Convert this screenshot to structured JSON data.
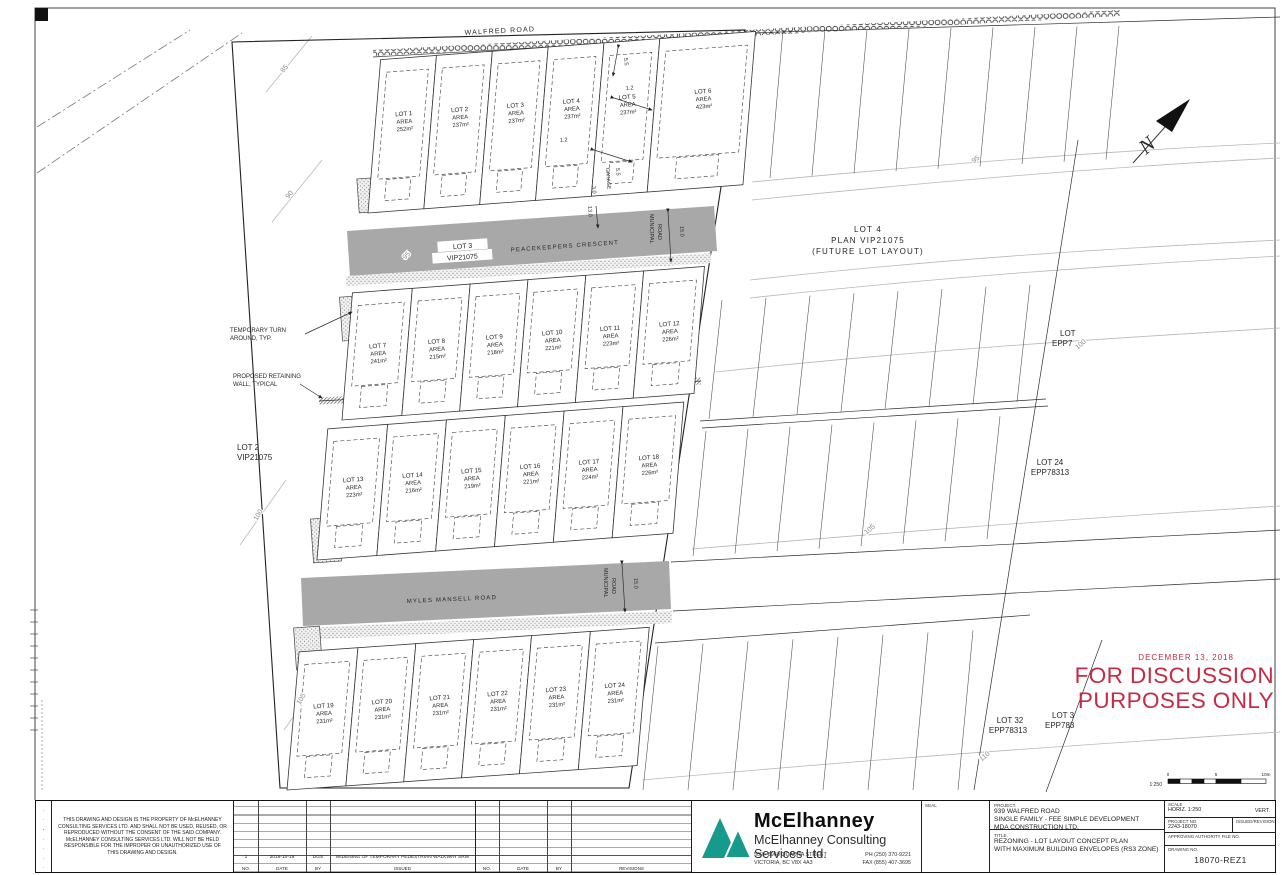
{
  "colors": {
    "stamp_red": "#c62a45",
    "logo_teal": "#159a8b",
    "road_gray": "#a8a8a8"
  },
  "plan": {
    "roads": {
      "walfred": "WALFRED ROAD",
      "peacekeepers": "PEACEKEEPERS CRESCENT",
      "myles": "MYLES MANSELL ROAD",
      "municipal1": "MUNICIPAL",
      "municipal2": "ROAD"
    },
    "area_label": "AREA",
    "lots": [
      {
        "name": "LOT 1",
        "area": "252m²"
      },
      {
        "name": "LOT 2",
        "area": "237m²"
      },
      {
        "name": "LOT 3",
        "area": "237m²"
      },
      {
        "name": "LOT 4",
        "area": "237m²"
      },
      {
        "name": "LOT 5",
        "area": "237m²"
      },
      {
        "name": "LOT 6",
        "area": "423m²"
      },
      {
        "name": "LOT 7",
        "area": "241m²"
      },
      {
        "name": "LOT 8",
        "area": "215m²"
      },
      {
        "name": "LOT 9",
        "area": "218m²"
      },
      {
        "name": "LOT 10",
        "area": "221m²"
      },
      {
        "name": "LOT 11",
        "area": "223m²"
      },
      {
        "name": "LOT 12",
        "area": "226m²"
      },
      {
        "name": "LOT 13",
        "area": "223m²"
      },
      {
        "name": "LOT 14",
        "area": "216m²"
      },
      {
        "name": "LOT 15",
        "area": "219m²"
      },
      {
        "name": "LOT 16",
        "area": "221m²"
      },
      {
        "name": "LOT 17",
        "area": "224m²"
      },
      {
        "name": "LOT 18",
        "area": "226m²"
      },
      {
        "name": "LOT 19",
        "area": "231m²"
      },
      {
        "name": "LOT 20",
        "area": "231m²"
      },
      {
        "name": "LOT 21",
        "area": "231m²"
      },
      {
        "name": "LOT 22",
        "area": "231m²"
      },
      {
        "name": "LOT 23",
        "area": "231m²"
      },
      {
        "name": "LOT 24",
        "area": "231m²"
      }
    ],
    "adjacent": {
      "lot3road": {
        "l1": "LOT 3",
        "l2": "VIP21075"
      },
      "lot2": {
        "l1": "LOT 2",
        "l2": "VIP21075"
      },
      "lot4": {
        "l1": "LOT 4",
        "l2": "PLAN VIP21075",
        "l3": "(FUTURE LOT LAYOUT)"
      },
      "eppA": {
        "l1": "LOT",
        "l2": "EPP7"
      },
      "lot24": {
        "l1": "LOT 24",
        "l2": "EPP78313"
      },
      "lot32": {
        "l1": "LOT 32",
        "l2": "EPP78313"
      },
      "eppB": {
        "l1": "LOT 3",
        "l2": "EPP783"
      }
    },
    "annotations": {
      "turn1": "TEMPORARY TURN",
      "turn2": "AROUND, TYP.",
      "ret1": "PROPOSED RETAINING",
      "ret2": "WALL, TYPICAL",
      "garage": "GARAGE"
    },
    "contours": {
      "c85": "85",
      "c90": "90",
      "c95l": "95",
      "c95r": "95",
      "c100l": "100",
      "c100r": "100",
      "c105l": "105",
      "c105r": "105",
      "c110": "110"
    },
    "dims": {
      "v55a": "5.5",
      "v12a": "1.2",
      "v12b": "1.2",
      "v55b": "5.5",
      "v30": "3.0",
      "v130": "13.0",
      "v150a": "15.0",
      "v150b": "15.0"
    },
    "north": "N",
    "scalebar": {
      "ratio": "1:250",
      "t0": "0",
      "t5": "5",
      "t10": "10m"
    }
  },
  "stamp": {
    "date": "DECEMBER 13, 2018",
    "line1": "FOR DISCUSSION",
    "line2": "PURPOSES ONLY"
  },
  "titleblock": {
    "copyright": "THIS DRAWING AND DESIGN IS THE PROPERTY OF McELHANNEY CONSULTING SERVICES LTD. AND SHALL NOT BE USED, REUSED, OR REPRODUCED WITHOUT THE CONSENT OF THE SAID COMPANY. McELHANNEY CONSULTING SERVICES LTD. WILL NOT BE HELD RESPONSIBLE FOR THE IMPROPER OR UNAUTHORIZED USE OF THIS DRAWING AND DESIGN.",
    "rev": {
      "h_no": "NO.",
      "h_date": "DATE",
      "h_by": "BY",
      "h_issued": "ISSUED",
      "h_revisions": "REVISIONS",
      "entry_no": "1",
      "entry_date": "2018-10-19",
      "entry_by": "DGS",
      "entry_desc": "WIDENING OF TEMPORARY PEDESTRIAN WALKWAY SRW"
    },
    "company": {
      "logo_name": "McElhanney",
      "name": "McElhanney Consulting Services Ltd.",
      "addr1": "500 - 3960 QUADRA STREET",
      "addr2": "VICTORIA, BC V8X 4A3",
      "ph": "PH (250) 370-9221",
      "fax": "FAX (855) 407-3695"
    },
    "seal_label": "SEAL",
    "project": {
      "label": "PROJECT.",
      "line1": "939 WALFRED ROAD",
      "line2": "SINGLE FAMILY - FEE SIMPLE DEVELOPMENT",
      "line3": "MDA CONSTRUCTION LTD."
    },
    "title": {
      "label": "TITLE.",
      "line1": "REZONING - LOT LAYOUT CONCEPT PLAN",
      "line2": "WITH MAXIMUM BUILDING ENVELOPES (RS3 ZONE)"
    },
    "info": {
      "scale_label": "SCALE",
      "horiz": "HORIZ. 1:250",
      "vert": "VERT.",
      "projno_label": "PROJECT NO.",
      "projno": "2243-18070",
      "rev_label": "ISSUED/REVISION",
      "auth_label": "APPROVING AUTHORITY FILE NO.",
      "dwg_label": "DRAWING NO.",
      "dwg": "18070-REZ1"
    }
  }
}
